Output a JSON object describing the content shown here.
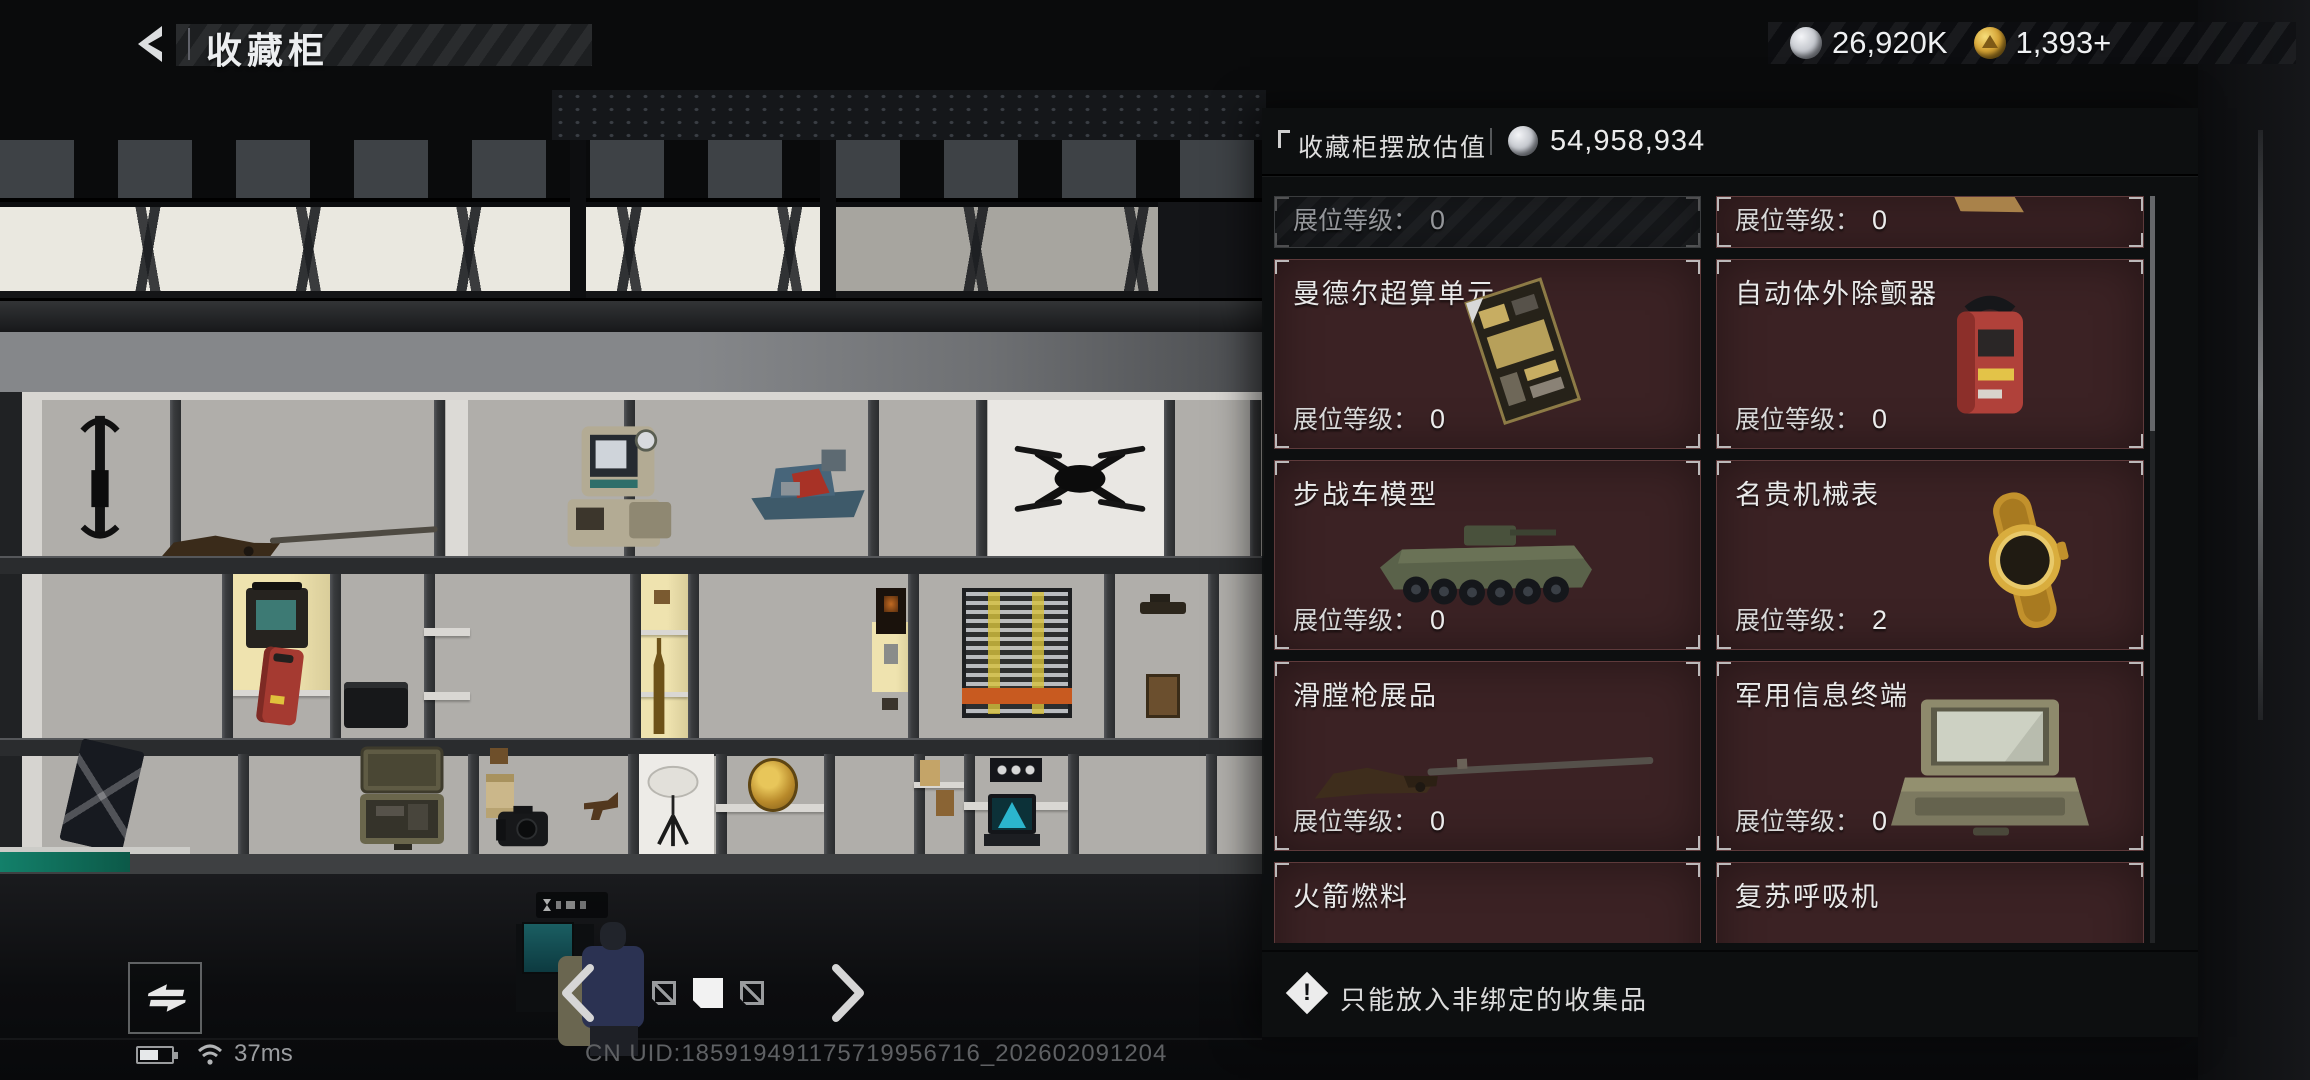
{
  "app": {
    "screen_title": "收藏柜"
  },
  "header": {
    "currencies": {
      "silver": {
        "icon": "silver-coin",
        "value": "26,920K"
      },
      "gold": {
        "icon": "gold-coin",
        "value": "1,393+"
      }
    }
  },
  "panel": {
    "title": "收藏柜摆放估值",
    "value_icon": "silver-coin",
    "total_value": "54,958,934",
    "level_label": "展位等级：",
    "cards": [
      {
        "name": "",
        "level": "0",
        "variant": "empty-slot"
      },
      {
        "name": "",
        "level": "0",
        "variant": "filled-partial"
      },
      {
        "name": "曼德尔超算单元",
        "level": "0",
        "item": "circuit-board"
      },
      {
        "name": "自动体外除颤器",
        "level": "0",
        "item": "defibrillator"
      },
      {
        "name": "步战车模型",
        "level": "0",
        "item": "ifv-model"
      },
      {
        "name": "名贵机械表",
        "level": "2",
        "item": "gold-watch"
      },
      {
        "name": "滑膛枪展品",
        "level": "0",
        "item": "musket"
      },
      {
        "name": "军用信息终端",
        "level": "0",
        "item": "military-terminal"
      },
      {
        "name": "火箭燃料",
        "item": "rocket-fuel"
      },
      {
        "name": "复苏呼吸机",
        "item": "ventilator"
      }
    ],
    "note": "只能放入非绑定的收集品"
  },
  "pagination": {
    "pages": 3,
    "active_index": 1
  },
  "status_bar": {
    "latency": "37ms",
    "uid": "CN UID:185919491175719956716_202602091204"
  },
  "colors": {
    "card_bg": "#3b2224",
    "panel_bg": "#0d0f11",
    "coin_silver": "#c6c9cf",
    "coin_gold": "#d5a335",
    "teal_accent": "#13806a"
  }
}
